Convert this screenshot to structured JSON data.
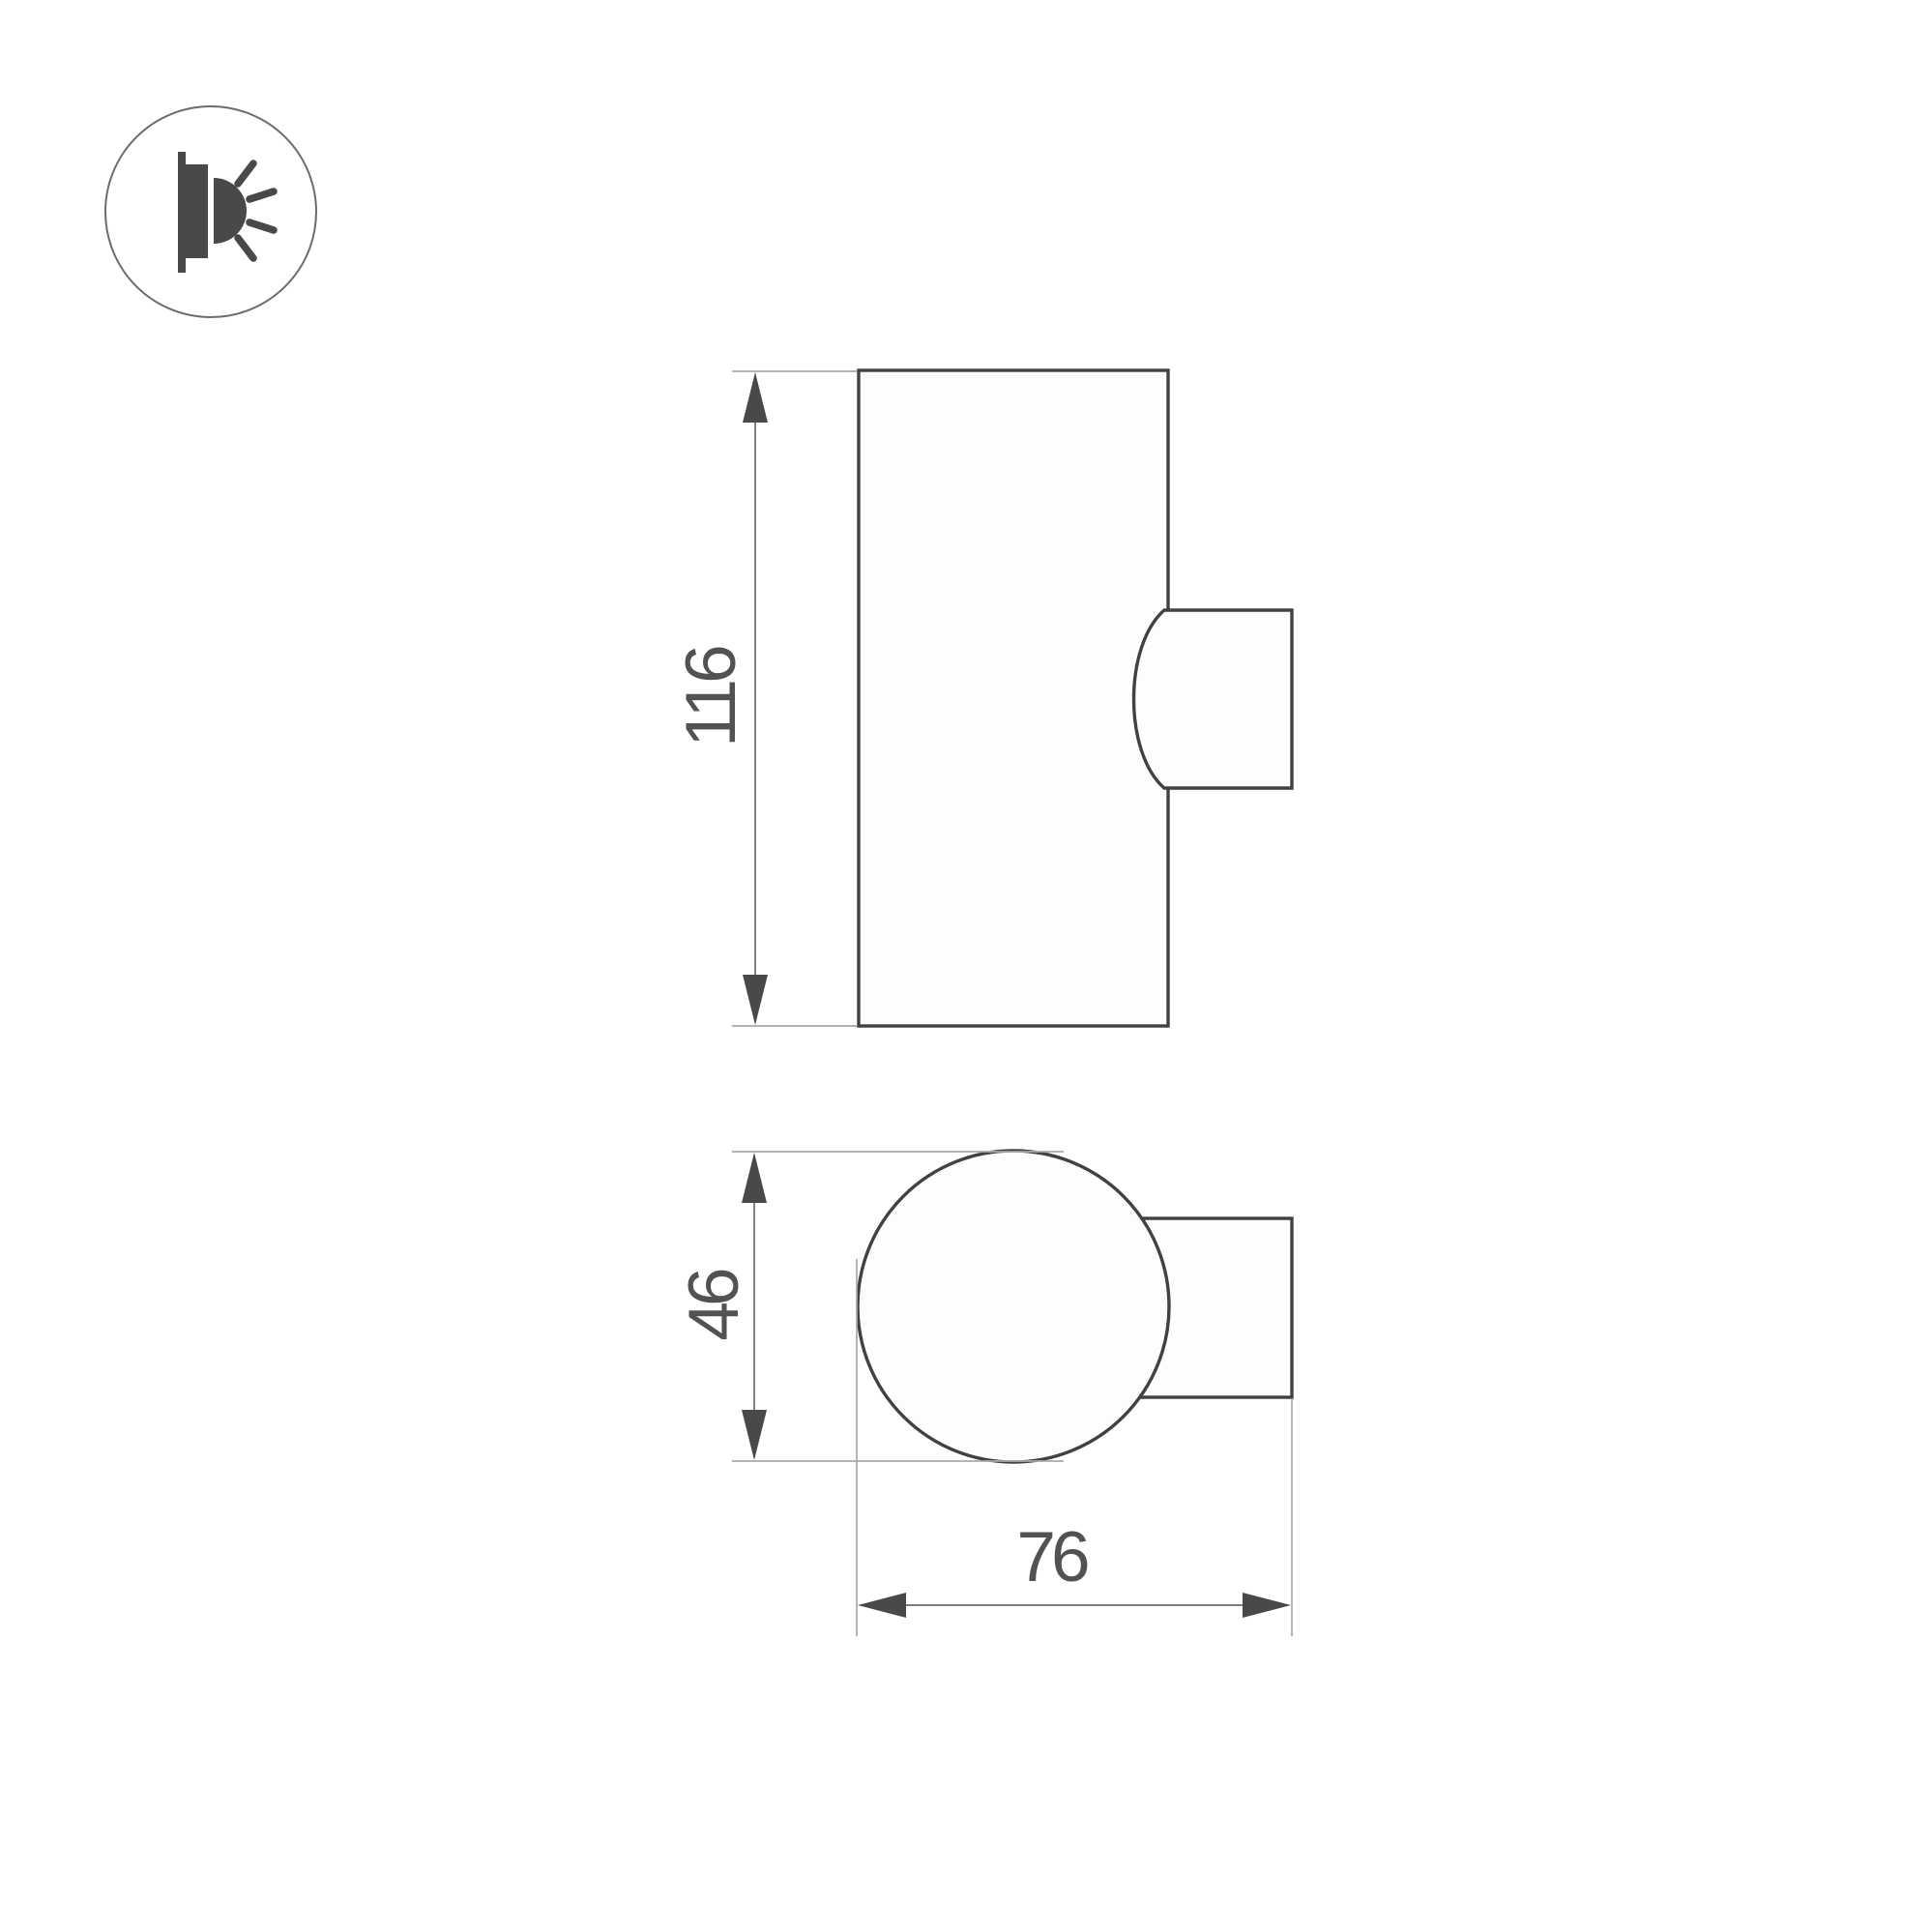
{
  "drawing": {
    "type": "technical-dimension-drawing",
    "product": "wall-mounted cylinder luminaire",
    "icon": "wall-light-side-glow-icon",
    "front_view": {
      "height_dimension": {
        "value": "116"
      }
    },
    "top_view": {
      "diameter_dimension": {
        "value": "46"
      },
      "depth_dimension": {
        "value": "76"
      }
    }
  },
  "colors": {
    "object_line": "#3f4245",
    "dimension_line": "#6a6c6e",
    "extension_line": "#a8a8a8",
    "arrow_fill": "#47494b",
    "text_color": "#505254",
    "icon_fill": "#48494b",
    "icon_circle": "#6a6c6e",
    "background": "#ffffff"
  }
}
